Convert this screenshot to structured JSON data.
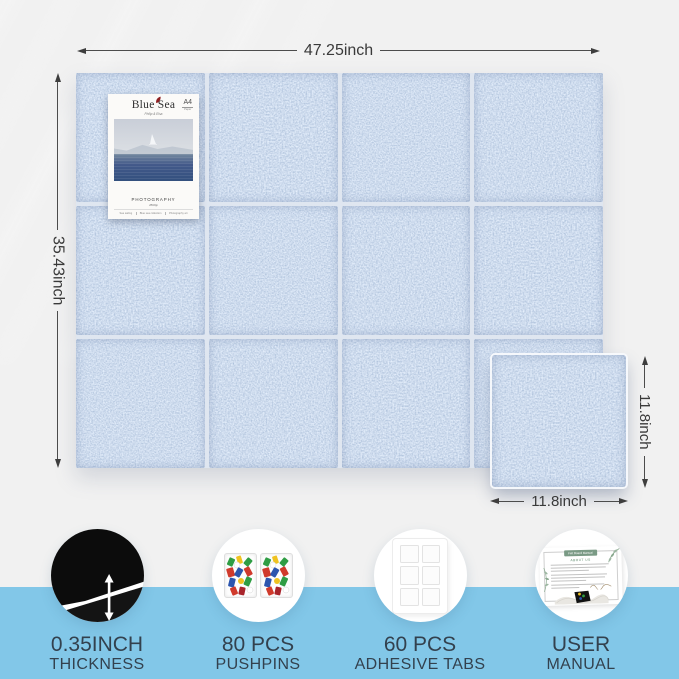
{
  "product": {
    "board": {
      "width_label": "47.25inch",
      "height_label": "35.43inch",
      "columns": 4,
      "rows": 3
    },
    "single_tile": {
      "height_label": "11.8inch",
      "width_label": "11.8inch"
    }
  },
  "poster": {
    "title": "Blue Sea",
    "subtitle": "Philip & Elsa",
    "corner_size": "A4",
    "corner_word": "Paper",
    "caption": "PHOTOGRAPHY",
    "author": "Philip",
    "meta": [
      "Sea sailing",
      "Blue sea collection",
      "Photography art"
    ]
  },
  "features": [
    {
      "value": "0.35INCH",
      "label": "THICKNESS",
      "icon": "thickness-arrow-icon"
    },
    {
      "value": "80 PCS",
      "label": "PUSHPINS",
      "icon": "pushpins-icon"
    },
    {
      "value": "60 PCS",
      "label": "ADHESIVE TABS",
      "icon": "adhesive-tabs-icon"
    },
    {
      "value": "USER",
      "label": "MANUAL",
      "icon": "user-manual-icon"
    }
  ],
  "manual_card": {
    "banner": "Felt Board Manual",
    "heading": "ABOUT US"
  },
  "colors": {
    "background_top": "#f1f1f1",
    "background_strip": "#82c7e8",
    "felt_blue": "#9db6d9",
    "label_text": "#33414e",
    "dimension_text": "#3a3a3a",
    "manual_green": "#7a9a85"
  }
}
